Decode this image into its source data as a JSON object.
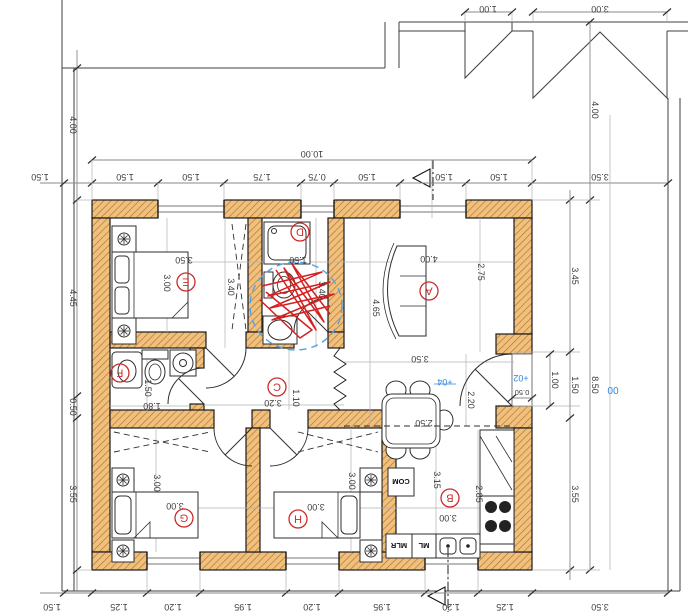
{
  "plan": {
    "type": "architectural floor plan, rotated 180 degrees",
    "overall": {
      "width": "10.00",
      "height": "8.50"
    },
    "site": {
      "canopy_small": "1.00",
      "canopy_large": "3.00",
      "top_left_offset": "4.00",
      "top_right_offset": "4.00",
      "left_gap": "1.50",
      "right_gap": "3.50",
      "bottom_left_gap": "1.50",
      "bottom_right_gap": "3.50"
    },
    "chains": {
      "top": [
        "1.50",
        "1.50",
        "1.75",
        "0.75",
        "1.50",
        "1.50",
        "1.50"
      ],
      "bottom": [
        "1.25",
        "1.20",
        "1.95",
        "1.20",
        "1.95",
        "1.20",
        "1.25"
      ],
      "left": [
        "4.45",
        "0.50",
        "3.55"
      ],
      "right": [
        "3.45",
        "1.50",
        "3.55"
      ]
    },
    "entry": {
      "door_width": "1.00",
      "landing_depth": "0.50",
      "hall_width": "2.20"
    },
    "levels": {
      "hall": "+04",
      "landing": "+02",
      "ground": "00"
    },
    "rooms": {
      "A": {
        "label": "A",
        "sofa_width": "4.00",
        "depth_right": "2.75",
        "depth_left": "4.65",
        "lower_width": "3.50"
      },
      "B": {
        "label": "B",
        "width": "3.00",
        "depth": "3.15",
        "depth_right": "2.85",
        "table_width": "2.50"
      },
      "C": {
        "label": "C",
        "width": "3.20",
        "depth": "1.10"
      },
      "D": {
        "label": "D",
        "width": "1.50",
        "depth": "3.40"
      },
      "E": {
        "label": "E",
        "width": "3.50",
        "inner_width": "3.00",
        "depth": "3.40"
      },
      "F": {
        "label": "F",
        "width": "1.80",
        "depth": "1.50"
      },
      "G": {
        "label": "G",
        "width": "3.00",
        "depth": "3.00"
      },
      "H": {
        "label": "H",
        "width": "3.00",
        "depth": "3.00"
      }
    },
    "appliances": {
      "com": "COM",
      "ml": "ML",
      "mlr": "MLR"
    },
    "colors": {
      "wall_fill": "#f2c07d",
      "wall_hatch": "#ad7b36",
      "room_label": "#cf2b2b",
      "level_text": "#2f86e0",
      "dim_text": "#3c3c3c",
      "markup_red": "#d42020",
      "markup_blue": "#55a0e8"
    }
  }
}
